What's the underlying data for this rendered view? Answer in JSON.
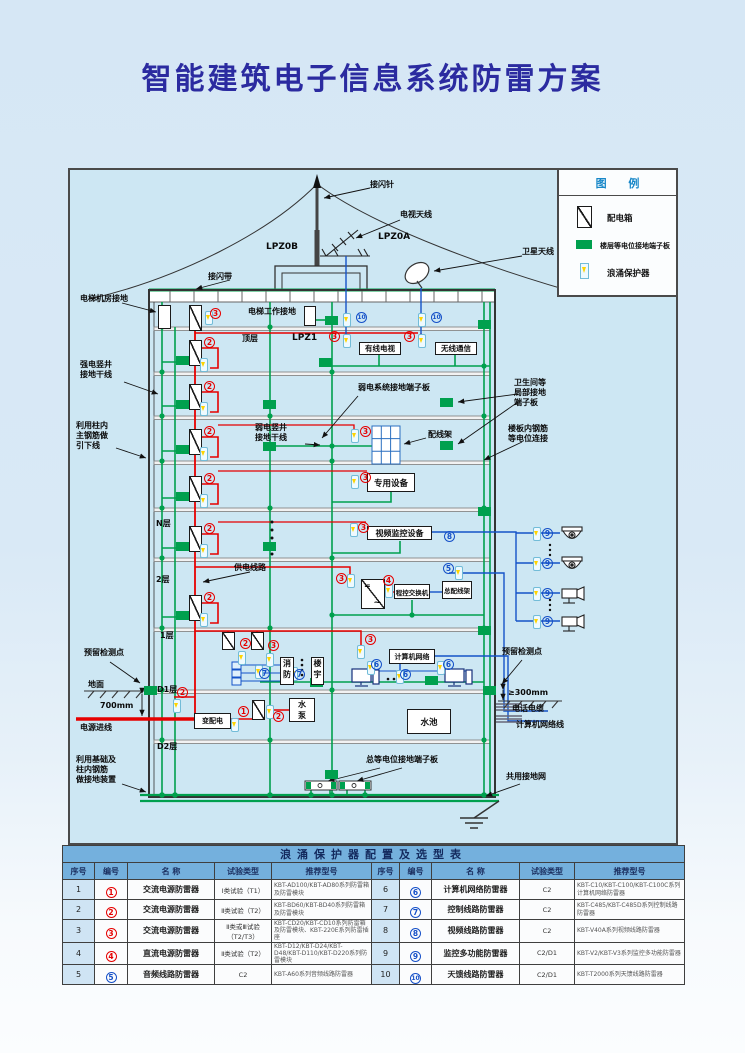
{
  "page": {
    "title": "智能建筑电子信息系统防雷方案"
  },
  "legend": {
    "title": "图 例",
    "items": [
      "配电箱",
      "楼层等电位接地端子板",
      "浪涌保护器"
    ]
  },
  "colors": {
    "ground_green": "#00a04e",
    "power_red": "#e60000",
    "signal_blue": "#1453c8",
    "accent_blue": "#1787c8",
    "title_navy": "#2b2ba0"
  },
  "labels": {
    "air_terminal": "接闪针",
    "tv_antenna": "电视天线",
    "lpz0a": "LPZ0A",
    "lpz0b": "LPZ0B",
    "satellite": "卫星天线",
    "air_belt": "接闪带",
    "elev_room": "电梯机房接地",
    "elev_work": "电梯工作接地",
    "top_floor": "顶层",
    "lpz1": "LPZ1",
    "strong_shaft": "强电竖井\n接地干线",
    "weak_board": "弱电系统接地端子板",
    "toilet": "卫生间等\n局部接地\n端子板",
    "weak_shaft": "弱电竖井\n接地干线",
    "frame": "配线架",
    "slab_rebar": "楼板内钢筋\n等电位连接",
    "column_rebar": "利用柱内\n主钢筋做\n引下线",
    "n_floor": "N层",
    "power_line": "供电线路",
    "f2": "2层",
    "f1": "1层",
    "d1": "D1层",
    "d2": "D2层",
    "reserved_l": "预留检测点",
    "ground": "地面",
    "dim700": "700mm",
    "power_in": "电源进线",
    "foundation": "利用基础及\n柱内钢筋\n做接地装置",
    "main_epb": "总等电位接地端子板",
    "reserved_r": "预留检测点",
    "dim300": "≥300mm",
    "tel_cable": "电话电缆",
    "net_cable": "计算机网络线",
    "common_ground": "共用接地网"
  },
  "boxes": {
    "cable_tv": "有线电视",
    "wireless": "无线通信",
    "special": "专用设备",
    "video": "视频监控设备",
    "pbx": "程控交换机",
    "mdf": "总配线架",
    "computer": "计算机网络",
    "fire": "消\n防",
    "building": "楼\n宇",
    "transformer": "变配电",
    "pump": "水\n泵",
    "pool": "水池",
    "conv_top": "=",
    "conv_bottom": "~"
  },
  "badges": [
    "3",
    "10",
    "10",
    "3",
    "3",
    "2",
    "2",
    "2",
    "3",
    "2",
    "3",
    "2",
    "3",
    "8",
    "2",
    "3",
    "4",
    "5",
    "9",
    "9",
    "9",
    "9",
    "2",
    "3",
    "7",
    "7",
    "3",
    "6",
    "6",
    "6",
    "2",
    "1",
    "2"
  ],
  "table": {
    "title": "浪涌保护器配置及选型表",
    "headers": [
      "序号",
      "编号",
      "名  称",
      "试验类型",
      "推荐型号"
    ],
    "rows": [
      {
        "l": {
          "no": "1",
          "num": "1",
          "name": "交流电源防雷器",
          "type": "Ⅰ类试验（T1）",
          "model": "KBT-AD100/KBT-AD80系列防雷箱及防雷模块"
        },
        "r": {
          "no": "6",
          "num": "6",
          "name": "计算机网络防雷器",
          "type": "C2",
          "model": "KBT-C10/KBT-C100/KBT-C100C系列计算机网络防雷器"
        }
      },
      {
        "l": {
          "no": "2",
          "num": "2",
          "name": "交流电源防雷器",
          "type": "Ⅱ类试验（T2）",
          "model": "KBT-BD60/KBT-BD40系列防雷箱及防雷模块"
        },
        "r": {
          "no": "7",
          "num": "7",
          "name": "控制线路防雷器",
          "type": "C2",
          "model": "KBT-C485/KBT-C485D系列控制线路防雷器"
        }
      },
      {
        "l": {
          "no": "3",
          "num": "3",
          "name": "交流电源防雷器",
          "type": "Ⅱ类或Ⅲ试验（T2/T3）",
          "model": "KBT-CD20/KBT-CD10系列防雷箱及防雷模块、KBT-220E系列防雷插座"
        },
        "r": {
          "no": "8",
          "num": "8",
          "name": "视频线路防雷器",
          "type": "C2",
          "model": "KBT-V40A系列视频线路防雷器"
        }
      },
      {
        "l": {
          "no": "4",
          "num": "4",
          "name": "直流电源防雷器",
          "type": "Ⅱ类试验（T2）",
          "model": "KBT-D12/KBT-D24/KBT-D48/KBT-D110/KBT-D220系列防雷模块"
        },
        "r": {
          "no": "9",
          "num": "9",
          "name": "监控多功能防雷器",
          "type": "C2/D1",
          "model": "KBT-V2/KBT-V3系列监控多功能防雷器"
        }
      },
      {
        "l": {
          "no": "5",
          "num": "5",
          "name": "音频线路防雷器",
          "type": "C2",
          "model": "KBT-A60系列音频线路防雷器"
        },
        "r": {
          "no": "10",
          "num": "10",
          "name": "天馈线路防雷器",
          "type": "C2/D1",
          "model": "KBT-T2000系列天馈线路防雷器"
        }
      }
    ]
  }
}
